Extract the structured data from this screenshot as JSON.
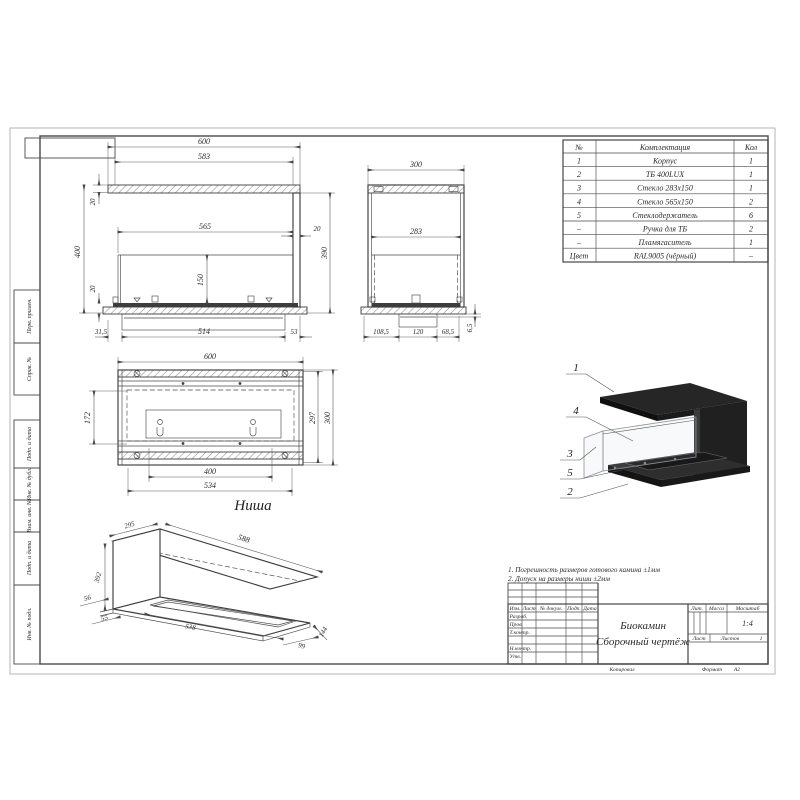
{
  "margin_labels": [
    "Перв. примен.",
    "Справ. №",
    "Подп. и дата",
    "Инв. № дубл.",
    "Взам. инв. №",
    "Подп. и дата",
    "Инв. № подл."
  ],
  "parts_table": {
    "headers": [
      "№",
      "Комплектация",
      "Кол"
    ],
    "rows": [
      [
        "1",
        "Корпус",
        "1"
      ],
      [
        "2",
        "ТБ 400LUX",
        "1"
      ],
      [
        "3",
        "Стекло 283х150",
        "1"
      ],
      [
        "4",
        "Стекло 565х150",
        "2"
      ],
      [
        "5",
        "Стеклодержатель",
        "6"
      ],
      [
        "–",
        "Ручка для ТБ",
        "2"
      ],
      [
        "–",
        "Пламягаситель",
        "1"
      ],
      [
        "Цвет",
        "RAL9005 (чёрный)",
        "–"
      ]
    ]
  },
  "notes": {
    "line1": "1. Погрешность размеров готового камина ±1мм",
    "line2": "2. Допуск на размеры ниши ±2мм"
  },
  "views": {
    "front": {
      "d600": "600",
      "d583": "583",
      "d565": "565",
      "d150": "150",
      "d400": "400",
      "d390": "390",
      "d20_top": "20",
      "d20_bottom": "20",
      "d20_right": "20",
      "d31_5": "31,5",
      "d514": "514",
      "d53": "53"
    },
    "side": {
      "d300": "300",
      "d283": "283",
      "d108_5": "108,5",
      "d120": "120",
      "d68_5": "68,5",
      "d6_5": "6,5"
    },
    "plan": {
      "label": "Ниша",
      "d600": "600",
      "d172": "172",
      "d297": "297",
      "d300": "300",
      "d400": "400",
      "d534": "534"
    },
    "iso": {
      "d295": "295",
      "d588": "588",
      "d392": "392",
      "d56": "56",
      "d55": "55",
      "d538": "538",
      "d99": "99",
      "d144": "144"
    },
    "render": {
      "callout_1": "1",
      "callout_2": "2",
      "callout_3": "3",
      "callout_4": "4",
      "callout_5": "5"
    }
  },
  "title_block": {
    "col_izm": "Изм.",
    "col_list": "Лист",
    "col_doc": "№ докум.",
    "col_podp": "Подп.",
    "col_data": "Дата",
    "row_razrab": "Разраб.",
    "row_prov": "Пров.",
    "row_tkontr": "Т.контр.",
    "row_nkontr": "Н.контр.",
    "row_utv": "Утв.",
    "title_line1": "Биокамин",
    "title_line2": "Сборочный чертёж",
    "lit": "Лит.",
    "mass": "Масса",
    "scale": "Масштаб",
    "scale_value": "1:4",
    "sheet": "Лист",
    "sheets": "Листов",
    "sheets_value": "1",
    "copied": "Копировал",
    "format_label": "Формат",
    "format_value": "А2"
  },
  "colors": {
    "line": "#3d3d3d",
    "render_dark": "#1a1a1a",
    "accent": "#2b2b2b"
  }
}
